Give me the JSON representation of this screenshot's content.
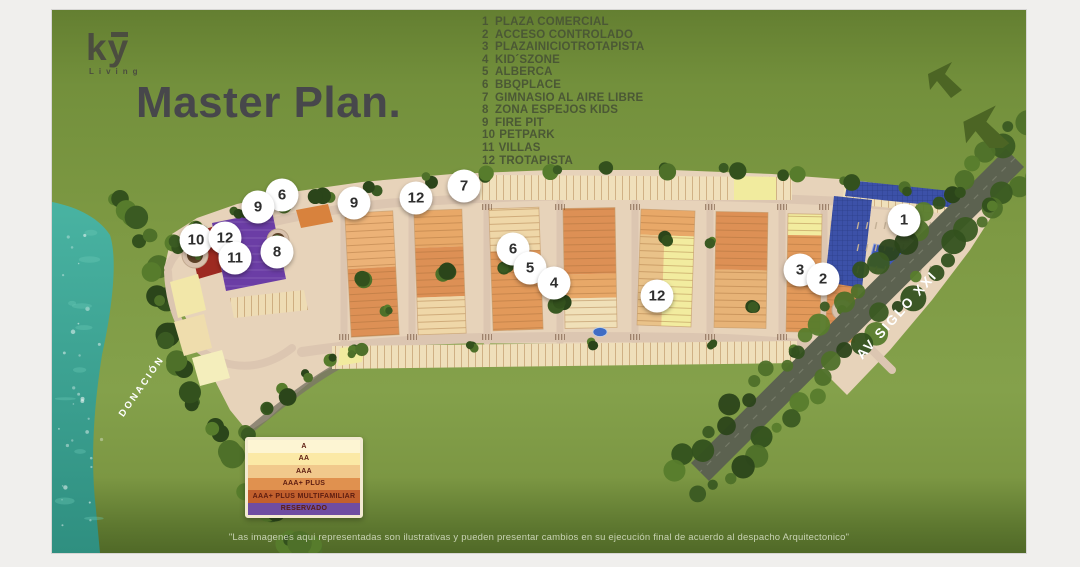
{
  "logo": {
    "text": "ky",
    "subtext": "Living"
  },
  "title": "Master Plan.",
  "legend": {
    "items": [
      {
        "num": "1",
        "label": "PLAZA COMERCIAL"
      },
      {
        "num": "2",
        "label": "ACCESO CONTROLADO"
      },
      {
        "num": "3",
        "label": "PLAZAINICIOTROTAPISTA"
      },
      {
        "num": "4",
        "label": "KID´SZONE"
      },
      {
        "num": "5",
        "label": "ALBERCA"
      },
      {
        "num": "6",
        "label": "BBQPLACE"
      },
      {
        "num": "7",
        "label": "GIMNASIO AL AIRE LIBRE"
      },
      {
        "num": "8",
        "label": "ZONA ESPEJOS KIDS"
      },
      {
        "num": "9",
        "label": "FIRE PIT"
      },
      {
        "num": "10",
        "label": "PETPARK"
      },
      {
        "num": "11",
        "label": "VILLAS"
      },
      {
        "num": "12",
        "label": "TROTAPISTA"
      }
    ]
  },
  "map": {
    "labels": {
      "donacion": "DONACIÓN",
      "avenue": "AV SIGLO XXI"
    },
    "markers": [
      {
        "n": "6",
        "x": 230,
        "y": 185
      },
      {
        "n": "9",
        "x": 206,
        "y": 197
      },
      {
        "n": "10",
        "x": 144,
        "y": 230
      },
      {
        "n": "12",
        "x": 173,
        "y": 228
      },
      {
        "n": "11",
        "x": 183,
        "y": 248
      },
      {
        "n": "8",
        "x": 225,
        "y": 242
      },
      {
        "n": "9",
        "x": 302,
        "y": 193
      },
      {
        "n": "12",
        "x": 364,
        "y": 188
      },
      {
        "n": "7",
        "x": 412,
        "y": 176
      },
      {
        "n": "6",
        "x": 461,
        "y": 239
      },
      {
        "n": "5",
        "x": 478,
        "y": 258
      },
      {
        "n": "4",
        "x": 502,
        "y": 273
      },
      {
        "n": "12",
        "x": 605,
        "y": 286
      },
      {
        "n": "3",
        "x": 748,
        "y": 260
      },
      {
        "n": "2",
        "x": 771,
        "y": 269
      },
      {
        "n": "1",
        "x": 852,
        "y": 210
      }
    ]
  },
  "key": {
    "rows": [
      {
        "label": "A",
        "color": "#fdf5d3"
      },
      {
        "label": "AA",
        "color": "#fbe9a6"
      },
      {
        "label": "AAA",
        "color": "#f1c98c"
      },
      {
        "label": "AAA+ PLUS",
        "color": "#e0914f"
      },
      {
        "label": "AAA+ PLUS MULTIFAMILIAR",
        "color": "#c2602d"
      },
      {
        "label": "RESERVADO",
        "color": "#6f4da2"
      }
    ],
    "text_color": "#5c1c10"
  },
  "disclaimer": "\"Las imagenes aqui representadas son ilustrativas y pueden presentar cambios en su ejecución final de acuerdo al despacho Arquitectonico\"",
  "colors": {
    "background_green": "#7d9943",
    "footer_green": "#506927",
    "water_teal": "#3aa393",
    "reserved_purple": "#6b3da5",
    "multifamiliar_red": "#9d2a21",
    "solar_blue": "#3c51a8",
    "title_gray": "#47474b",
    "legend_text": "#4b5835"
  }
}
